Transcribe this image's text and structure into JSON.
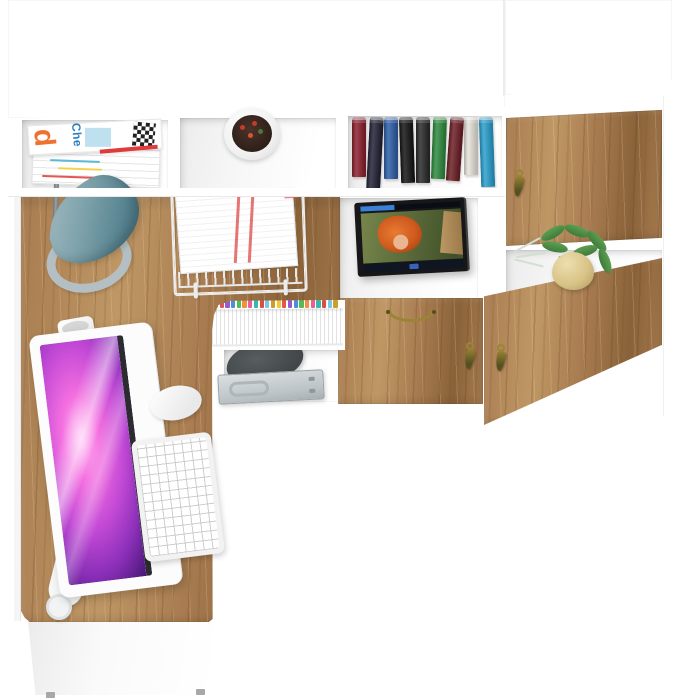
{
  "scene": {
    "type": "3D product render, top-down view",
    "subject": "White and craft-oak home office set: wall storage unit with open shelves and cabinet doors, and an L-shaped corner desk with computer",
    "objects": [
      "wall-unit",
      "magazine-stack",
      "flower-pot-top",
      "books-row",
      "upper-right-cabinet-door",
      "desk-lamp",
      "paper-tray",
      "media-screen",
      "plant-on-shelf",
      "file-folders",
      "dark-pouch",
      "metal-case",
      "center-drawer",
      "lower-right-cabinet-door",
      "corner-desk",
      "pen-cup",
      "monitor",
      "keyboard",
      "mouse",
      "desk-front-panel"
    ]
  },
  "magazine": {
    "cover_letter": "d",
    "cover_text": "Che"
  },
  "colors": {
    "background": "#ffffff",
    "panel_edge": "#e8e8e8",
    "wood": "#a87c50",
    "wood_light": "#bf9765",
    "wood_dark": "#8a6239",
    "lamp_shade_light": "#a6bcc2",
    "lamp_shade_mid": "#7fa3ac",
    "lamp_shade_dark": "#52808d",
    "lamp_base": "#b3bfc2",
    "lamp_arm": "#9aa1a4",
    "brass": "#9a8435",
    "brass_dark": "#55511f",
    "tv_bezel": "#17171a",
    "tv_bar": "#101522",
    "tv_accent": "#3a7fd9",
    "movie_bg_light": "#76854a",
    "movie_bg_dark": "#41522a",
    "movie_hair": "#cf5a1e",
    "movie_skin": "#e9b68f",
    "movie_branch": "#caa06a",
    "screen_pink": "#ffc4f4",
    "screen_magenta": "#f46fe0",
    "screen_purple": "#8b2fb8",
    "screen_deep": "#241048",
    "case_metal": "#bcc3c7",
    "case_metal_dark": "#99a1a5",
    "bag": "#3f4446",
    "plant_green": "#3f7a3a",
    "plant_green_light": "#5ca052",
    "pot_beige": "#d9c488",
    "paper_red": "#e05252",
    "magazine_orange": "#f07030",
    "magazine_blue": "#2a7fc0",
    "magazine_lightblue": "#bfe0ef",
    "magazine_red": "#e03a3a",
    "foot_gray": "#a8a8a8"
  },
  "books": [
    {
      "color": "#8c2130",
      "h": 60,
      "tilt": 0
    },
    {
      "color": "#232338",
      "h": 72,
      "tilt": 3
    },
    {
      "color": "#2f5fa8",
      "h": 62,
      "tilt": 0
    },
    {
      "color": "#161616",
      "h": 66,
      "tilt": -2
    },
    {
      "color": "#2b2b2b",
      "h": 66,
      "tilt": 0
    },
    {
      "color": "#2f8b3f",
      "h": 62,
      "tilt": 2
    },
    {
      "color": "#6e2026",
      "h": 64,
      "tilt": 4
    },
    {
      "color": "#e7e4dc",
      "h": 58,
      "tilt": 0
    },
    {
      "color": "#2aa0cf",
      "h": 70,
      "tilt": -2
    }
  ],
  "folder_tabs": [
    "#f2c933",
    "#e25555",
    "#9b59d0",
    "#4a90d9",
    "#58b957",
    "#f2913d",
    "#e85f9a",
    "#38b8a8",
    "#d94f3f",
    "#7cc4e8",
    "#caa02a",
    "#f2c933",
    "#e25555",
    "#9b59d0",
    "#4a90d9",
    "#58b957",
    "#f2913d",
    "#e85f9a",
    "#38b8a8",
    "#d94f3f",
    "#7cc4e8",
    "#caa02a"
  ],
  "pens": [
    {
      "color": "#2b2b2b",
      "angle": -62,
      "len": 34
    },
    {
      "color": "#e8b930",
      "angle": -38,
      "len": 38
    },
    {
      "color": "#d94f3f",
      "angle": -15,
      "len": 40
    },
    {
      "color": "#3f6fd9",
      "angle": 5,
      "len": 36
    },
    {
      "color": "#4fae52",
      "angle": -80,
      "len": 30
    },
    {
      "color": "#f08030",
      "angle": 28,
      "len": 34
    },
    {
      "color": "#8a8f93",
      "angle": 48,
      "len": 36
    },
    {
      "color": "#caa02a",
      "angle": -50,
      "len": 42
    },
    {
      "color": "#333333",
      "angle": 18,
      "len": 44
    },
    {
      "color": "#7cc4e8",
      "angle": 70,
      "len": 26
    },
    {
      "color": "#c04a8a",
      "angle": -28,
      "len": 30
    }
  ]
}
